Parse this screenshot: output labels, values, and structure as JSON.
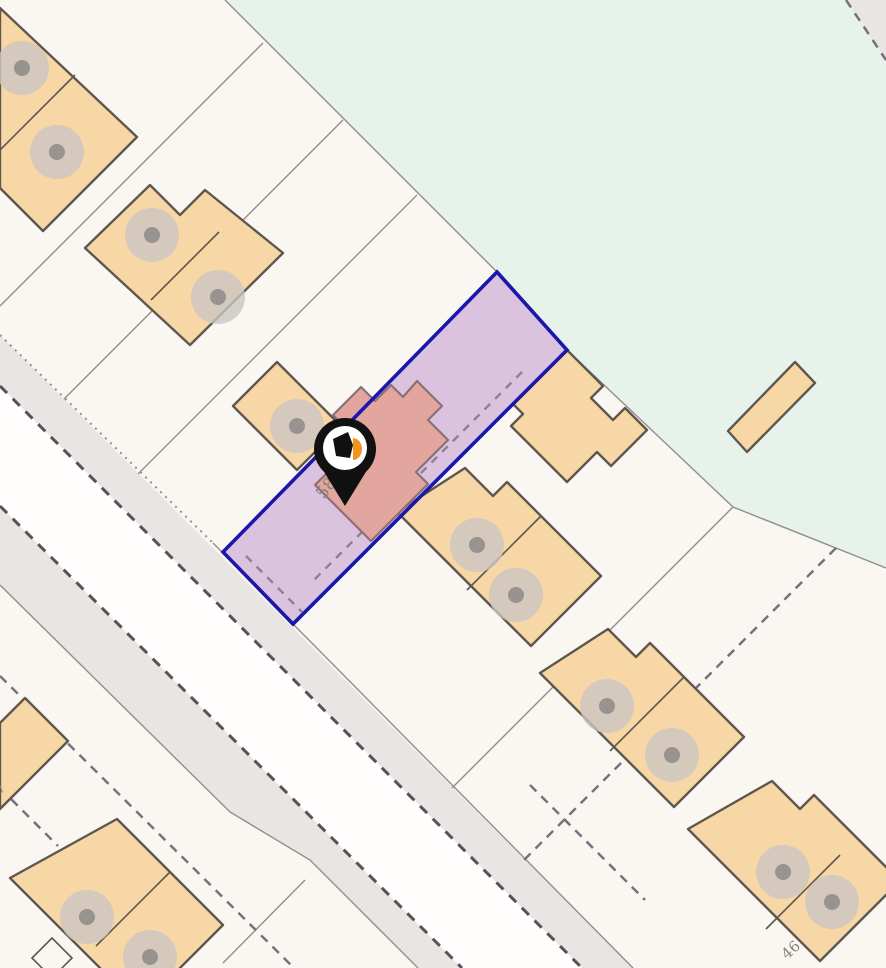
{
  "labels": {
    "subject_house_number": "58",
    "neighbor_house_number_46": "46",
    "neighbor_house_number_7": "7"
  },
  "pin": {
    "description": "black map pin with house logo marking property 58"
  },
  "colors": {
    "bg": "#faf7f3",
    "green": "#e7f3ea",
    "road_gray": "#e9e5e3",
    "carriageway": "#fffefd",
    "thin_line": "#928e88",
    "dark_dash": "#56525c",
    "mid_dash": "#76727b",
    "building": "#f8d7a6",
    "building_border": "#5d574d",
    "tree_outer": "#cbc6c2",
    "tree_inner": "#98938e",
    "parcel_fill": "#bb8fcd",
    "parcel_outline": "#1c17ab",
    "inner_dash": "#8f7f92",
    "subject_building": "#e3a69e",
    "subject_border": "#8c6f77",
    "label": "#87817a",
    "pin_black": "#111111",
    "pin_orange": "#f0931f"
  }
}
